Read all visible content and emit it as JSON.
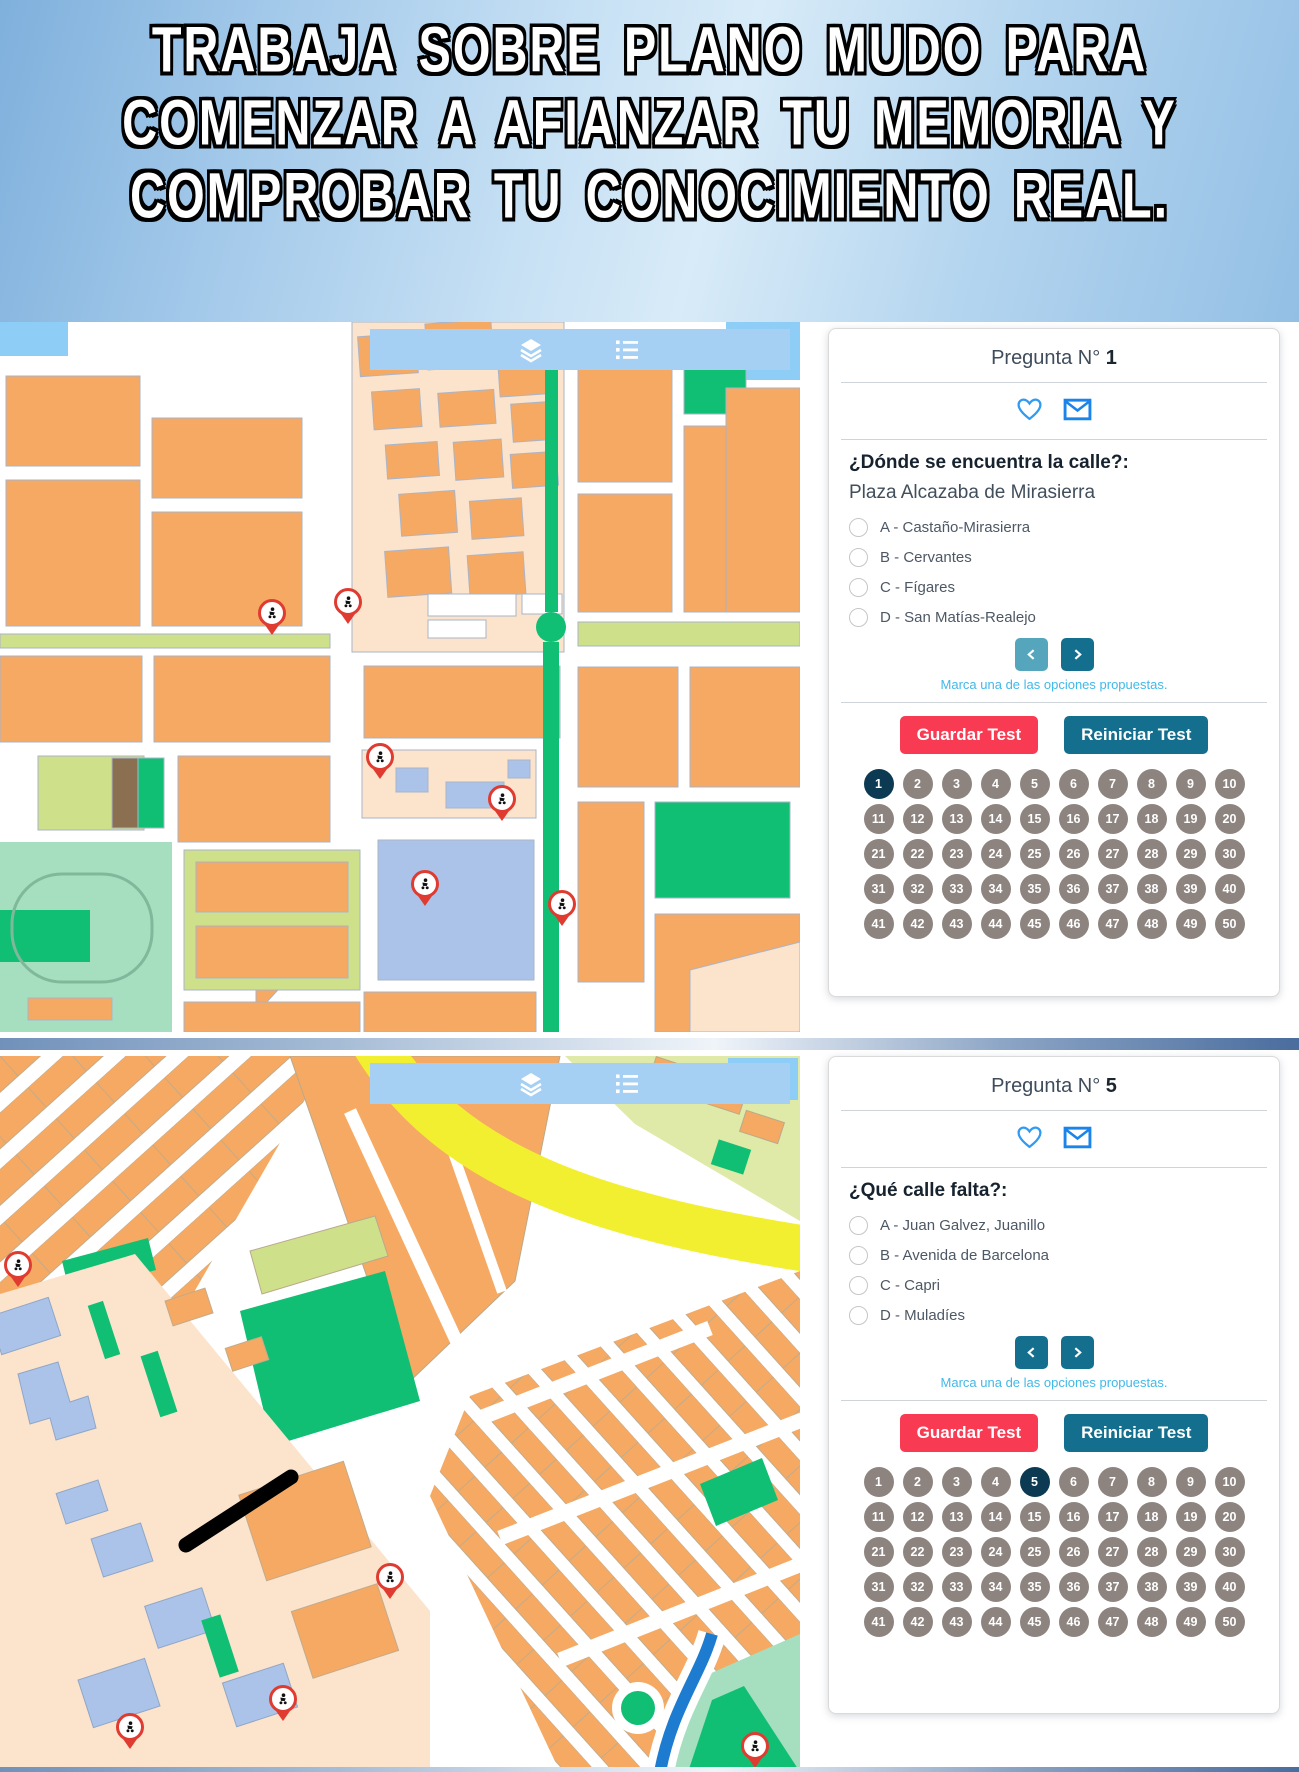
{
  "header": {
    "lines": [
      "TRABAJA SOBRE PLANO MUDO PARA",
      "COMENZAR A AFIANZAR TU MEMORIA Y",
      "COMPROBAR TU CONOCIMIENTO REAL."
    ]
  },
  "map_toolbar": {
    "icons": [
      "layers-icon",
      "list-icon"
    ]
  },
  "colors": {
    "header_gradient": [
      "#7fb0dc",
      "#d8ebf8",
      "#93bfe5"
    ],
    "toolbar_blue": "#a5d0f3",
    "save_red": "#f83b52",
    "teal_dark": "#146f8e",
    "teal_disabled": "#55a6bc",
    "hint_blue": "#41b9e9",
    "circle_gray": "#8d8480",
    "circle_active": "#0c3a52",
    "heart_blue": "#2f9bf2",
    "envelope_blue": "#1b84ea",
    "map_orange": "#f6a962",
    "map_peach": "#fbe3cc",
    "map_yellow_green": "#cfe08a",
    "map_green": "#10bf73",
    "map_mint": "#a5dfc0",
    "map_lavender": "#abc3e8",
    "map_sky": "#8ecdf5",
    "map_road_yellow": "#f2ef31",
    "map_river_blue": "#1e7cd0",
    "pin_red": "#e03b31"
  },
  "sections": [
    {
      "panel": {
        "question_label": "Pregunta N°",
        "question_number": "1",
        "question": "¿Dónde se encuentra la calle?:",
        "street": "Plaza Alcazaba de Mirasierra",
        "options": [
          "A - Castaño-Mirasierra",
          "B - Cervantes",
          "C - Fígares",
          "D - San Matías-Realejo"
        ],
        "hint": "Marca una de las opciones propuestas.",
        "save_label": "Guardar Test",
        "reset_label": "Reiniciar Test",
        "numbers_total": 50,
        "active_number": 1,
        "prev_enabled": false,
        "next_enabled": true
      },
      "map": {
        "pins": [
          [
            272,
            311
          ],
          [
            348,
            300
          ],
          [
            380,
            455
          ],
          [
            425,
            582
          ],
          [
            502,
            497
          ],
          [
            562,
            602
          ]
        ]
      }
    },
    {
      "panel": {
        "question_label": "Pregunta N°",
        "question_number": "5",
        "question": "¿Qué calle falta?:",
        "street": "",
        "options": [
          "A - Juan Galvez, Juanillo",
          "B - Avenida de Barcelona",
          "C - Capri",
          "D - Muladíes"
        ],
        "hint": "Marca una de las opciones propuestas.",
        "save_label": "Guardar Test",
        "reset_label": "Reiniciar Test",
        "numbers_total": 50,
        "active_number": 5,
        "prev_enabled": true,
        "next_enabled": true
      },
      "map": {
        "pins": [
          [
            18,
            229
          ],
          [
            390,
            541
          ],
          [
            283,
            663
          ],
          [
            130,
            691
          ],
          [
            755,
            710
          ]
        ],
        "missing_street_line": {
          "x1": 186,
          "y1": 489,
          "x2": 291,
          "y2": 421
        }
      }
    }
  ]
}
